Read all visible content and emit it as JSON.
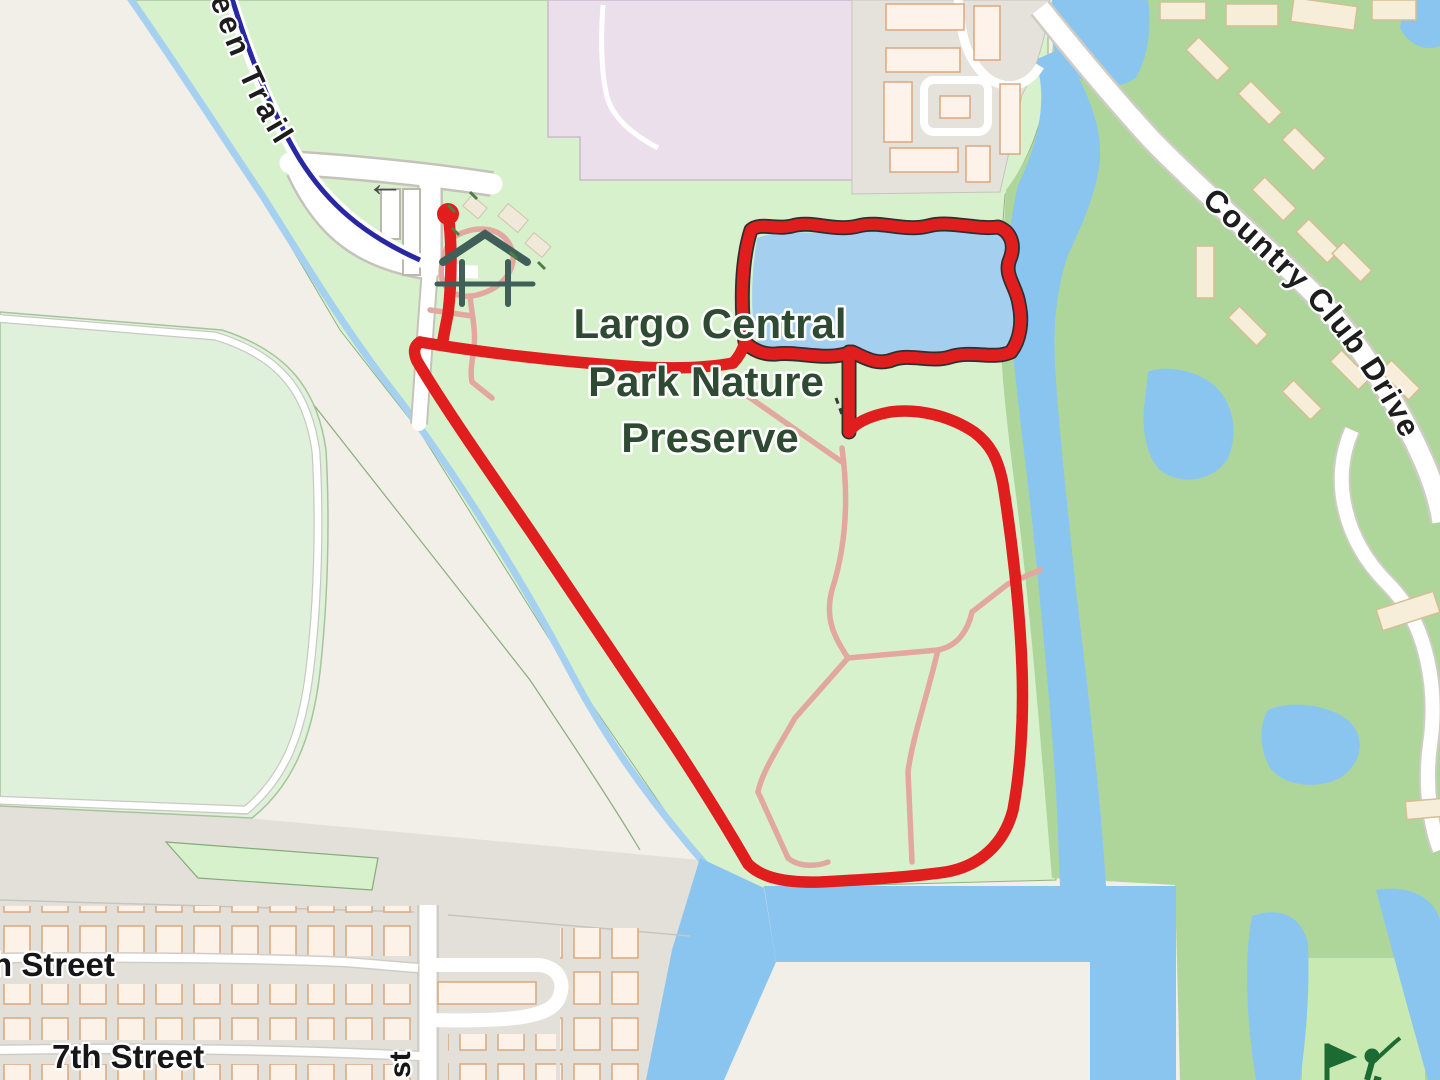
{
  "map": {
    "area_labels": {
      "park_name_line1": "Largo Central",
      "park_name_line2": "Park Nature",
      "park_name_line3": "Preserve"
    },
    "road_labels": {
      "country_club_drive": "Country Club Drive",
      "trail_partial": "reen Trail",
      "street_8th_partial": "h Street",
      "street_7th": "7th Street",
      "street_vertical_partial": "st"
    },
    "icons": {
      "oneway_arrow_glyph": "←",
      "oneway_arrow": "left-arrow-icon",
      "shelter": "picnic-shelter-icon",
      "golf": "golf-course-icon",
      "route_start": "route-start-dot"
    },
    "colors": {
      "land_beige": "#f2efe9",
      "park_green": "#d8f1cd",
      "field_green": "#dff1da",
      "golf_green": "#aed69b",
      "fairway_green": "#c8e9b2",
      "water_blue": "#8ac5f0",
      "lake_blue": "#a5cfee",
      "residential_gray": "#e5e2dc",
      "retail_lavender": "#ecdfec",
      "trail_blue": "#2828a2",
      "path_pink": "#e2a79f",
      "route_red": "#e01e1e"
    }
  }
}
